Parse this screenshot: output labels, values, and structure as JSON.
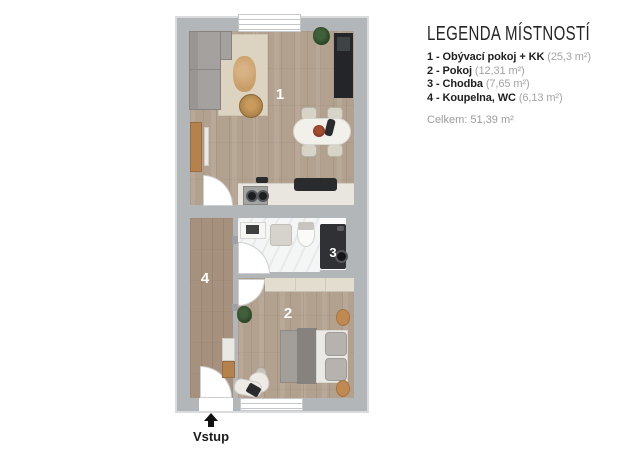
{
  "legend": {
    "title": "LEGENDA MÍSTNOSTÍ",
    "items": [
      {
        "label": "1 - Obývací pokoj + KK",
        "area": "(25,3 m²)"
      },
      {
        "label": "2 - Pokoj",
        "area": "(12,31 m²)"
      },
      {
        "label": "3 - Chodba",
        "area": "(7,65 m²)"
      },
      {
        "label": "4 - Koupelna, WC",
        "area": "(6,13 m²)"
      }
    ],
    "total": "Celkem: 51,39 m²"
  },
  "plan": {
    "room_labels": {
      "living": "1",
      "bedroom": "2",
      "washer": "3",
      "hallway": "4"
    },
    "entrance_label": "Vstup"
  },
  "colors": {
    "wall": "#b2b6b9",
    "wall_outline": "#d9dbdd",
    "floor_wood": "#b3a190",
    "floor_wood_dark": "#a6917e",
    "floor_marble": "#f4f5f5",
    "accent_wood": "#b5824e",
    "room_label": "#ffffff",
    "legend_text": "#1f1f1f",
    "legend_muted": "#a3a3a3"
  }
}
